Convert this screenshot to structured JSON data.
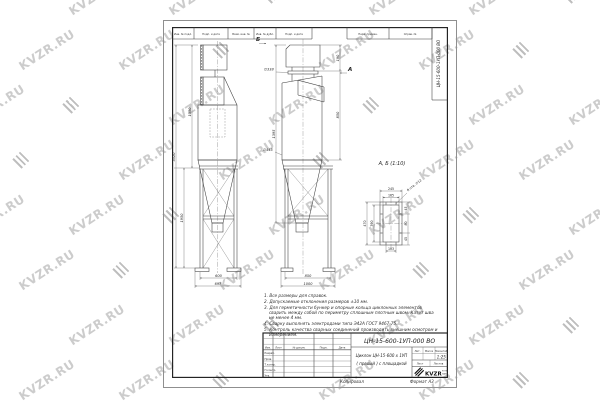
{
  "watermark": {
    "text": "KVZR.RU",
    "color": "#b9b9b9"
  },
  "sheet": {
    "top_cells": [
      "Инв. № подл.",
      "Подп. и дата",
      "Взам. инв. №",
      "Инв. № дубл.",
      "Подп. и дата",
      "Перв. примен.",
      "Справ. №"
    ],
    "side_stamp": "ЦН-15-600-1УП-000 ВО",
    "footer_copied": "Копировал",
    "footer_format": "Формат А3"
  },
  "views": {
    "front": {
      "dim_h_upper": "1350",
      "dim_h_stand": "1950",
      "dim_h_total": "3520",
      "dim_w_inner": "600",
      "dim_w_outer": "697"
    },
    "side": {
      "marker_b": "Б",
      "marker_a": "А",
      "dim_flange": "∅338",
      "dim_body": "∅445",
      "dim_h_box": "190",
      "dim_h_body": "850",
      "dim_h_left": "1395",
      "dim_w_inner": "850",
      "dim_w_outer": "1000"
    },
    "detail": {
      "title": "А, Б (1:10)",
      "dim_w_outer": "245",
      "dim_w_inner": "165",
      "dim_h_outer": "470",
      "dim_h_inner": "390",
      "chain": [
        "45",
        "80",
        "45"
      ],
      "dim_holes_span": "103",
      "holes_note": "8 отв. ∅12"
    }
  },
  "notes": [
    "1. Все размеры для справок.",
    "2. Допускаемые отклонения размеров ±10 мм.",
    "3. Для герметичности бункер и опорные кольца циклонных элементов сварить между собой по периметру сплошным плотным швом. Катет шва не менее 4 мм.",
    "4. Сварку выполнять электродами типа Э42А ГОСТ 9467-75.",
    "5. Контроль качества сварных соединений производить внешним осмотром и измерением."
  ],
  "title_block": {
    "doc_number": "ЦН-15-600-1УП-000  ВО",
    "name_line1": "Циклон ЦН-15-600 х 1УП",
    "name_line2": "( правый )  с площадкой",
    "scale_value": "1:25",
    "col_izm": "Изм.",
    "col_list": "Лист",
    "col_doc": "№ докум.",
    "col_podp": "Подп.",
    "col_data": "Дата",
    "row_razrab": "Разраб.",
    "row_prov": "Пров.",
    "row_tkontr": "Т.контр.",
    "row_nkontr": "Н.контр.",
    "row_utv": "Утв.",
    "lit_label": "Лит.",
    "mass_label": "Масса",
    "scale_label": "Масштаб",
    "list_label": "Лист",
    "listov_label": "Листов",
    "logo_text": "KVZR",
    "logo_sub1": "КОТЕЛЬНЫЙ",
    "logo_sub2": "ЗАВОД"
  }
}
